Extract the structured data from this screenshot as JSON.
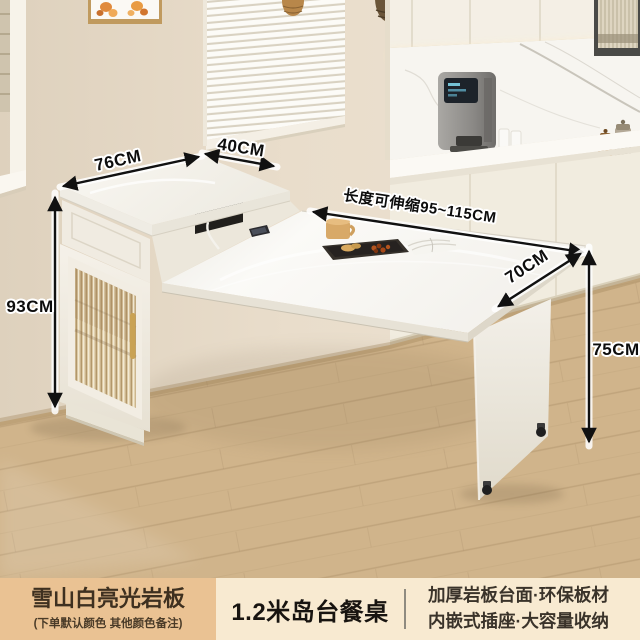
{
  "product_card": {
    "dimension_labels": {
      "cabinet_top_width": "76CM",
      "cabinet_top_depth": "40CM",
      "cabinet_height": "93CM",
      "table_length": "长度可伸缩95~115CM",
      "table_depth": "70CM",
      "table_height": "75CM"
    },
    "info_bar": {
      "finish_name": "雪山白亮光岩板",
      "finish_note": "(下单默认颜色 其他颜色备注)",
      "product_title": "1.2米岛台餐桌",
      "features": [
        "加厚岩板台面·环保板材",
        "内嵌式插座·大容量收纳"
      ]
    },
    "colors": {
      "finish_badge_bg": "#eac293",
      "info_bar_bg": "#f8ead1",
      "info_text": "#3a332a",
      "dimension_arrow": "#111111",
      "wall_beige": "#e7dcca",
      "floor_wood": "#c9ab7e",
      "furniture_white": "#f4f0e8",
      "door_handle_gold": "#c9a254",
      "socket_panel_black": "#211f1c"
    }
  }
}
